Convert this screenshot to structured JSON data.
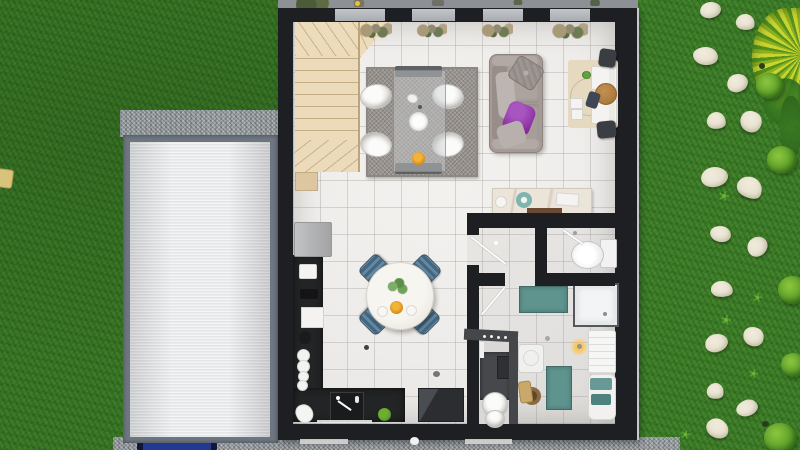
{
  "scene": {
    "title": "House ground floor - 3D top-down floor plan render",
    "type": "floor-plan-render"
  },
  "palette": {
    "grass": "#3e7f29",
    "house_wall": "#1d1f23",
    "floor_tile": "#f0eeeb",
    "kitchen_counter": "#222426",
    "stairs": "#ecdbba",
    "garage_roof": "#eceeef",
    "roof_frame": "#6d7681",
    "gravel": "#9aa0a4",
    "living_rug": "#98938e",
    "sofa": "#a49b97",
    "accent_purple": "#8b2fa0",
    "kitchen_chair_blue": "#6089a6",
    "bath_mat_teal": "#5f938e",
    "stepping_stone": "#e8e2d0",
    "bush_green": "#6fae2c",
    "ornamental_grass": "#c9d52f",
    "desk_mat_beige": "#e5d9c0",
    "console_marble": "#eae4d9",
    "trailer_blue": "#23398f",
    "bowl_orange": "#e2941c"
  },
  "rooms": {
    "living": {
      "label": "Living / dining room",
      "furniture": [
        "gray sofa with purple cushion",
        "glass dining table",
        "4 white tub chairs",
        "gray shag rug",
        "desk with chair and stools",
        "marble console table"
      ]
    },
    "kitchen": {
      "label": "Kitchen",
      "furniture": [
        "fridge",
        "L-shaped black counter",
        "sink",
        "cooktop",
        "round white table",
        "4 steel-blue chairs"
      ]
    },
    "hallway": {
      "label": "Hallway"
    },
    "wc": {
      "label": "WC",
      "furniture": [
        "toilet"
      ]
    },
    "bathroom": {
      "label": "Bathroom",
      "furniture": [
        "shower cabin",
        "washing machine",
        "towel radiator",
        "bathtub with teal towels",
        "laundry basket",
        "teal bath mats",
        "wall lamp"
      ]
    },
    "nook": {
      "label": "Study nook",
      "furniture": [
        "dark desk",
        "white chair",
        "wall hooks"
      ]
    },
    "staircase": {
      "label": "Winder staircase"
    }
  },
  "exterior": {
    "garage": {
      "label": "Garage with corrugated roll roof",
      "apron": "gravel apron"
    },
    "driveway_object": {
      "label": "Blue trailer at garage door"
    },
    "left_object": {
      "label": "Wooden post at lawn edge"
    },
    "garden": {
      "label": "Lawn with stepping-stone path and bushes",
      "stepping_stones": [
        [
          710,
          10,
          21,
          16,
          -8
        ],
        [
          745,
          22,
          19,
          16,
          12
        ],
        [
          705,
          56,
          25,
          18,
          5
        ],
        [
          737,
          83,
          21,
          18,
          -14
        ],
        [
          716,
          120,
          19,
          17,
          8
        ],
        [
          751,
          121,
          22,
          21,
          40
        ],
        [
          714,
          177,
          27,
          20,
          -5
        ],
        [
          750,
          187,
          26,
          21,
          30
        ],
        [
          720,
          234,
          21,
          16,
          10
        ],
        [
          757,
          246,
          21,
          19,
          -35
        ],
        [
          722,
          289,
          22,
          16,
          6
        ],
        [
          753,
          336,
          21,
          19,
          25
        ],
        [
          716,
          343,
          23,
          18,
          -12
        ],
        [
          715,
          391,
          17,
          16,
          15
        ],
        [
          747,
          408,
          22,
          16,
          -20
        ],
        [
          717,
          428,
          23,
          19,
          35
        ]
      ],
      "bushes": [
        [
          770,
          86,
          28
        ],
        [
          782,
          160,
          30
        ],
        [
          793,
          290,
          30
        ],
        [
          794,
          365,
          26
        ],
        [
          780,
          438,
          33
        ]
      ],
      "star_plants": [
        [
          724,
          196,
          10
        ],
        [
          757,
          297,
          9
        ],
        [
          726,
          320,
          10
        ],
        [
          753,
          373,
          9
        ],
        [
          685,
          434,
          9
        ]
      ],
      "ornamental_grass": {
        "label": "Yellow-green ornamental grass clump"
      }
    }
  }
}
